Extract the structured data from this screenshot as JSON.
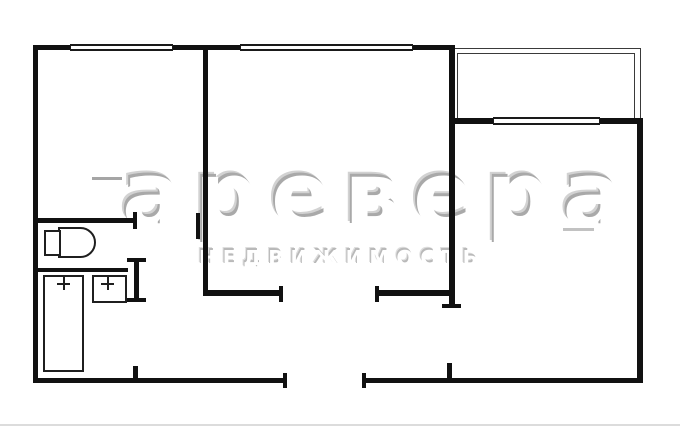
{
  "watermark": {
    "brand": "аревера",
    "subtitle": "НЕДВИЖИМОСТЬ"
  },
  "plan": {
    "type": "apartment-floor-plan",
    "rooms": [
      {
        "name": "room-left"
      },
      {
        "name": "room-middle"
      },
      {
        "name": "room-right"
      },
      {
        "name": "wc"
      },
      {
        "name": "bathroom"
      },
      {
        "name": "hallway"
      },
      {
        "name": "balcony"
      }
    ],
    "fixtures": [
      {
        "name": "toilet"
      },
      {
        "name": "bathtub"
      },
      {
        "name": "sink"
      }
    ],
    "window_count": 3,
    "door_openings": 6
  },
  "colors": {
    "background": "#ffffff",
    "wall": "#111111",
    "fixture_outline": "#1f1f1f",
    "balcony_line": "#3a3a3a",
    "watermark_shadow": "#a9a9a9",
    "scan_edge": "#dcdcdc"
  }
}
